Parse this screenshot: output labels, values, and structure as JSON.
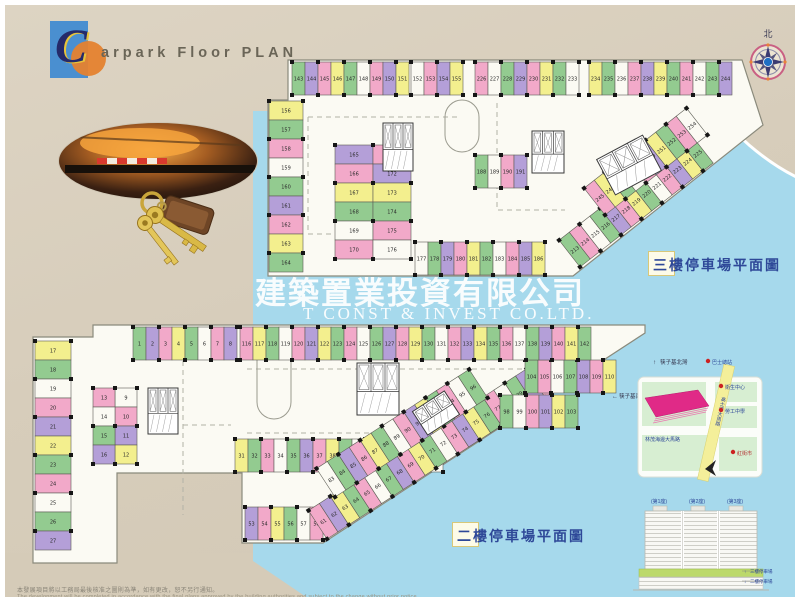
{
  "page": {
    "background": "#d7cdbb",
    "water": "#a6d9ec",
    "plan_fill": "#fbfaf3"
  },
  "title": {
    "initial": "C",
    "rest": "arpark Floor PLAN"
  },
  "compass": {
    "north_label": "北"
  },
  "watermark": {
    "line1": "建築置業投資有限公司",
    "line2": "T CONST & INVEST CO.LTD."
  },
  "plan_labels": {
    "third": "三樓停車場平面圖",
    "second": "二樓停車場平面圖"
  },
  "palette": {
    "green": "#93cb90",
    "pink": "#f2a9c9",
    "purple": "#b49fd8",
    "yellow": "#f3ef8e",
    "white": "#fbfaf3",
    "outline": "#5d5d55",
    "column": "#161616",
    "number": "#2a2a2a",
    "cycle": "gupygwpuygpw"
  },
  "plans": {
    "third": {
      "outline": "M283,55 L737,55 L758,120 L568,271 L263,271 L263,95 L283,95 Z",
      "islands": [
        {
          "x": 440,
          "y": 95,
          "w": 34,
          "h": 52
        }
      ],
      "cores": [
        {
          "x": 378,
          "y": 118,
          "w": 30,
          "h": 48,
          "rot": 0
        },
        {
          "x": 527,
          "y": 126,
          "w": 32,
          "h": 42,
          "rot": 0
        },
        {
          "x": 598,
          "y": 140,
          "w": 52,
          "h": 40,
          "rot": -28
        }
      ],
      "rows": [
        {
          "x": 287,
          "y": 57,
          "w": 13,
          "h": 33,
          "dir": "v",
          "from": 143,
          "to": 151
        },
        {
          "x": 406,
          "y": 57,
          "w": 13,
          "h": 33,
          "dir": "v",
          "from": 152,
          "to": 155
        },
        {
          "x": 470,
          "y": 57,
          "w": 13,
          "h": 33,
          "dir": "v",
          "from": 226,
          "to": 233
        },
        {
          "x": 584,
          "y": 57,
          "w": 13,
          "h": 33,
          "dir": "v",
          "from": 234,
          "to": 244
        },
        {
          "x": 264,
          "y": 96,
          "w": 34,
          "h": 19,
          "dir": "h",
          "from": 156,
          "to": 164
        },
        {
          "x": 330,
          "y": 140,
          "w": 38,
          "h": 19,
          "dir": "h",
          "from": 165,
          "to": 170
        },
        {
          "x": 368,
          "y": 140,
          "w": 38,
          "h": 19,
          "dir": "h",
          "from": 171,
          "to": 176
        },
        {
          "x": 410,
          "y": 237,
          "w": 13,
          "h": 33,
          "dir": "v",
          "from": 177,
          "to": 186
        },
        {
          "x": 470,
          "y": 150,
          "w": 13,
          "h": 33,
          "dir": "v",
          "from": 188,
          "to": 191
        },
        {
          "x": 0,
          "y": -34,
          "w": 13,
          "h": 34,
          "dir": "v",
          "from": 213,
          "to": 225,
          "rot": -38,
          "ox": 575,
          "oy": 262
        },
        {
          "x": 0,
          "y": -34,
          "w": 13,
          "h": 34,
          "dir": "v",
          "from": 245,
          "to": 254,
          "rot": -38,
          "ox": 600,
          "oy": 210
        }
      ]
    },
    "second": {
      "outline": "M28,332 L88,332 L88,320 L640,320 L640,328 L318,538 L237,538 L237,468 L112,468 L112,558 L28,558 Z",
      "islands": [
        {
          "x": 252,
          "y": 336,
          "w": 34,
          "h": 78
        }
      ],
      "cores": [
        {
          "x": 143,
          "y": 383,
          "w": 30,
          "h": 46,
          "rot": 0
        },
        {
          "x": 352,
          "y": 358,
          "w": 42,
          "h": 52,
          "rot": 0
        },
        {
          "x": 412,
          "y": 394,
          "w": 38,
          "h": 28,
          "rot": -33
        }
      ],
      "rows": [
        {
          "x": 128,
          "y": 322,
          "w": 13,
          "h": 33,
          "dir": "v",
          "from": 1,
          "to": 8
        },
        {
          "x": 110,
          "y": 383,
          "w": 22,
          "h": 19,
          "dir": "h",
          "from": 9,
          "to": 12
        },
        {
          "x": 88,
          "y": 383,
          "w": 22,
          "h": 19,
          "dir": "h",
          "from": 13,
          "to": 16
        },
        {
          "x": 30,
          "y": 336,
          "w": 36,
          "h": 19,
          "dir": "h",
          "from": 17,
          "to": 27
        },
        {
          "x": 230,
          "y": 434,
          "w": 13,
          "h": 33,
          "dir": "v",
          "from": 31,
          "to": 46
        },
        {
          "x": 240,
          "y": 502,
          "w": 13,
          "h": 33,
          "dir": "v",
          "from": 53,
          "to": 58
        },
        {
          "x": 0,
          "y": -34,
          "w": 13,
          "h": 34,
          "dir": "v",
          "from": 61,
          "to": 82,
          "rot": -33,
          "ox": 322,
          "oy": 534
        },
        {
          "x": 0,
          "y": -34,
          "w": 13,
          "h": 34,
          "dir": "v",
          "from": 83,
          "to": 96,
          "rot": -33,
          "ox": 330,
          "oy": 492
        },
        {
          "x": 495,
          "y": 390,
          "w": 13,
          "h": 33,
          "dir": "v",
          "from": 98,
          "to": 103
        },
        {
          "x": 520,
          "y": 355,
          "w": 13,
          "h": 33,
          "dir": "v",
          "from": 104,
          "to": 110
        },
        {
          "x": 235,
          "y": 322,
          "w": 13,
          "h": 33,
          "dir": "v",
          "from": 116,
          "to": 142
        }
      ]
    }
  },
  "map": {
    "north_arrow": "↑",
    "north_road": "筷子基北灣",
    "west_arrow": "←",
    "west_road": "筷子基南灣",
    "road_main": "高士德大馬路",
    "road_bottom": "林茂海邊大馬路",
    "pois": [
      {
        "label": "巴士總站"
      },
      {
        "label": "衛生中心"
      },
      {
        "label": "勞工中學"
      },
      {
        "label": "紅街市"
      }
    ],
    "site_color": "#e02a87",
    "road_color": "#f4ef9a",
    "poi_dot_color": "#cc2222"
  },
  "elevation": {
    "towers": [
      "(第1座)",
      "(第2座)",
      "(第3座)"
    ],
    "pointers": [
      {
        "arrow": "↑",
        "label": "三樓停車場"
      },
      {
        "arrow": "↓",
        "label": "二樓停車場"
      }
    ],
    "podium_color": "#bcd96b"
  },
  "disclaimer": {
    "zh": "本發展項目將以工務局最後核准之圖則為準，如有更改，恕不另行通知。",
    "en": "The development will be completed in accordance with the final plans approved by the building authorities and subject to the change without prior notice."
  }
}
